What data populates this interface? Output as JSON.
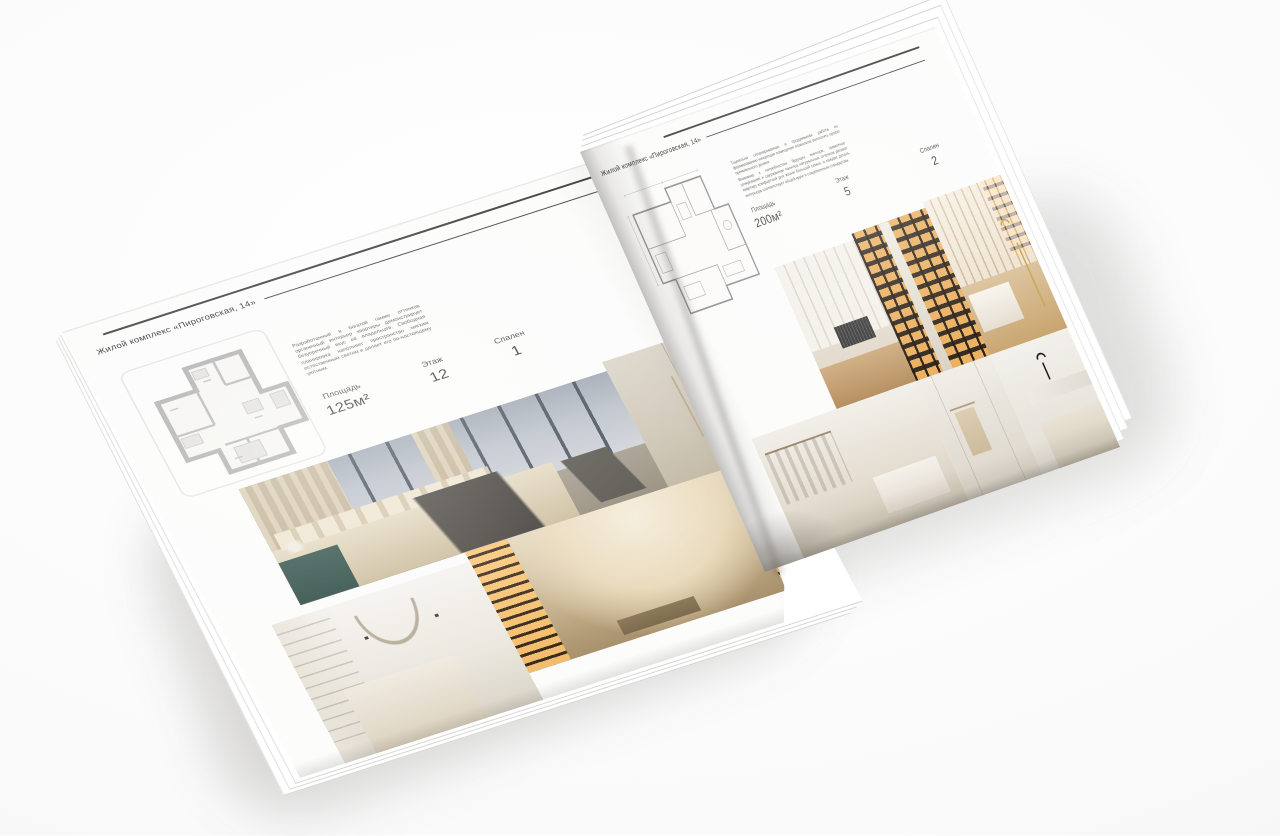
{
  "brochure": {
    "left_page": {
      "header": "Жилой комплекс «Пироговская, 14»",
      "description": "Разработанный в богатой гамме оттенков органичный интерьер квартиры демонстрирует безупречный вкус её владельцев. Свободная планировка наполняет пространство мягким естественным светом и делает его по-настоящему уютным.",
      "specs": [
        {
          "label": "Площадь",
          "value": "125м²"
        },
        {
          "label": "Этаж",
          "value": "12"
        },
        {
          "label": "Спален",
          "value": "1"
        }
      ],
      "floor_plan": "one-bedroom-apartment-plan",
      "photos": [
        "bedroom-with-panoramic-city-windows",
        "beige-wardrobe-doors",
        "hallway-with-illuminated-shelving",
        "white-bedroom-with-shelves"
      ]
    },
    "right_page": {
      "header": "Жилой комплекс «Пироговская, 14»",
      "description_1": "Тщательно спланированная и продуманная работа по формированию концепции помещения позволила воплотить проект премиального уровня.",
      "description_2": "Внимание к потребностям будущих жильцов, грамотное зонирование и сдержанная палитра натуральных оттенков делают квартиру комфортной для жизни большой семьи, а каждая деталь интерьера соответствует общей идее и современным стандартам.",
      "specs": [
        {
          "label": "Площадь",
          "value": "200м²"
        },
        {
          "label": "Этаж",
          "value": "5"
        },
        {
          "label": "Спален",
          "value": "2"
        }
      ],
      "floor_plan": "two-bedroom-apartment-plan",
      "photos": [
        "light-dressing-room",
        "illuminated-dark-wardrobe",
        "dressing-room-with-chaise-and-gold-lamp",
        "white-walk-in-closet",
        "bathroom-with-towel-rail",
        "marble-bathroom-vanity"
      ]
    },
    "colors": {
      "page": "#fcfcfb",
      "text": "#383838",
      "rule": "#3f3f3f",
      "plan_walls_left": "#aeaeae",
      "plan_lines_right": "#8a8a8a",
      "photo_warm_wood": "#c9a36e",
      "photo_dark_wardrobe": "#2c2118",
      "photo_shelf_glow": "#ffba5c",
      "photo_teal_vanity": "#32524b",
      "photo_gold_lamp": "#c79e4a"
    }
  }
}
